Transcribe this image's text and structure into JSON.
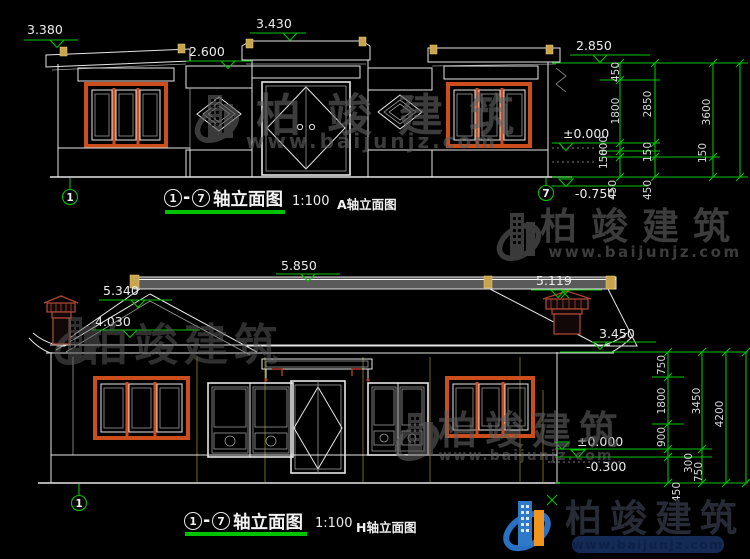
{
  "watermark": {
    "brand": "柏竣建筑",
    "url": "www.baijunjz.com"
  },
  "brand_logo": {
    "brand": "柏竣建筑",
    "url": "www.baijunjz.com"
  },
  "drawings": {
    "top": {
      "title_axis_from": "1",
      "title_sep": "-",
      "title_axis_to": "7",
      "title_text": "轴立面图",
      "scale": "1:100",
      "subtitle": "A轴立面图",
      "axis_left": "1",
      "axis_right": "7",
      "levels": {
        "roof_left": "3.380",
        "gate_top": "3.430",
        "wall_left": "2.600",
        "eave_right": "2.850",
        "zero": "±0.000",
        "base": "-0.750"
      },
      "dims": {
        "col1": [
          "450",
          "1800",
          "600",
          "150",
          "450"
        ],
        "col2": [
          "2850",
          "150",
          "450"
        ],
        "col3": [
          "3600",
          "150"
        ]
      }
    },
    "bottom": {
      "title_axis_from": "1",
      "title_sep": "-",
      "title_axis_to": "7",
      "title_text": "轴立面图",
      "scale": "1:100",
      "subtitle": "H轴立面图",
      "axis_left": "1",
      "levels": {
        "ridge": "5.850",
        "gable": "5.340",
        "chimney": "5.119",
        "slope": "4.030",
        "eave": "3.450",
        "zero": "±0.000",
        "minus": "-0.300"
      },
      "dims": {
        "col1": [
          "750",
          "1800",
          "900",
          "300",
          "450"
        ],
        "col2": [
          "3450",
          "750"
        ],
        "col3": [
          "4200"
        ]
      }
    }
  }
}
